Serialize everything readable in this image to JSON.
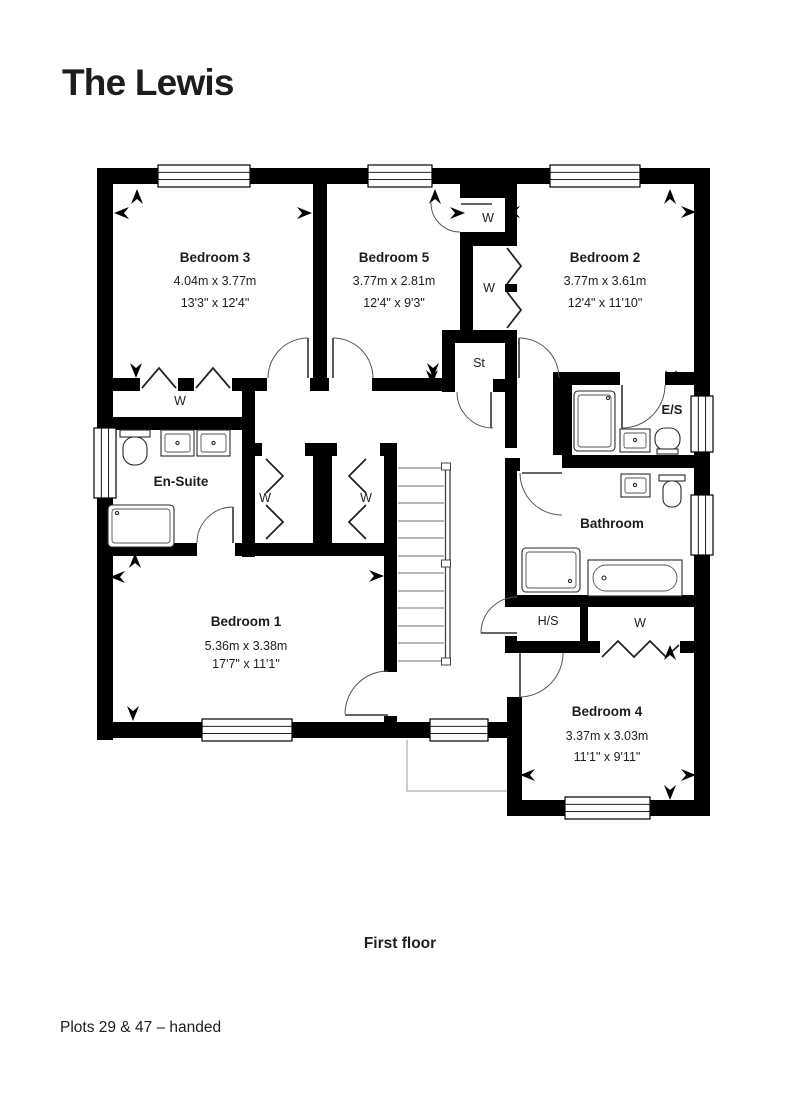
{
  "title": "The Lewis",
  "floor_label": "First floor",
  "plots_label": "Plots 29 & 47 – handed",
  "colors": {
    "accent": "#3fafaa",
    "ink": "#1d1d1b",
    "wall": "#000000"
  },
  "rooms": {
    "bedroom3": {
      "name": "Bedroom 3",
      "metric": "4.04m x 3.77m",
      "imperial": "13'3\" x 12'4\""
    },
    "bedroom5": {
      "name": "Bedroom 5",
      "metric": "3.77m x 2.81m",
      "imperial": "12'4\" x 9'3\""
    },
    "bedroom2": {
      "name": "Bedroom 2",
      "metric": "3.77m x 3.61m",
      "imperial": "12'4\" x 11'10\""
    },
    "bedroom1": {
      "name": "Bedroom 1",
      "metric": "5.36m x 3.38m",
      "imperial": "17'7\" x 11'1\""
    },
    "bedroom4": {
      "name": "Bedroom 4",
      "metric": "3.37m x 3.03m",
      "imperial": "11'1\" x 9'11\""
    },
    "ensuite": {
      "name": "En-Suite"
    },
    "bathroom": {
      "name": "Bathroom"
    },
    "es": {
      "name": "E/S"
    },
    "hs": {
      "name": "H/S"
    },
    "store": {
      "name": "St"
    },
    "wardrobe": {
      "name": "W"
    }
  }
}
